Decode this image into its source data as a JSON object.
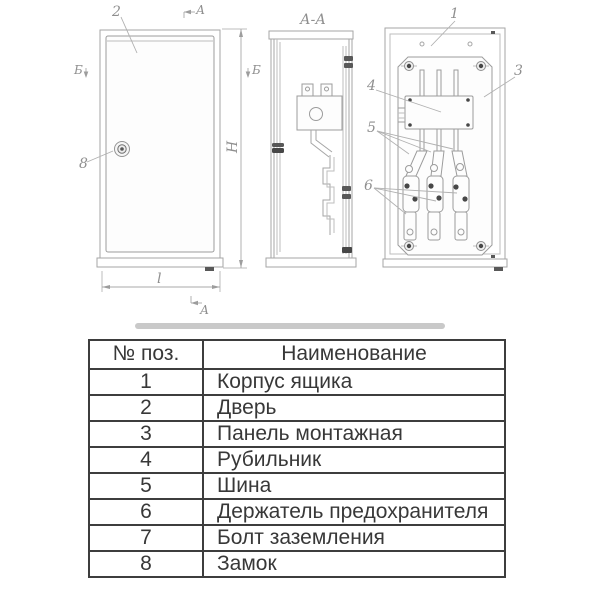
{
  "drawing": {
    "section_title": "А-А",
    "callouts": {
      "c1": "1",
      "c2": "2",
      "c3": "3",
      "c4": "4",
      "c5": "5",
      "c6": "6",
      "c8": "8"
    },
    "view_marks": {
      "section_top": "А",
      "section_bottom": "А",
      "b_left": "Б",
      "b_right": "Б"
    },
    "dimensions": {
      "height": "Н",
      "width": "l"
    },
    "colors": {
      "line": "#a6a6a6",
      "dark_detail": "#585858",
      "label_text": "#8f8f8f"
    }
  },
  "table": {
    "headers": {
      "pos": "№ поз.",
      "name": "Наименование"
    },
    "rows": [
      {
        "num": "1",
        "name": "Корпус ящика"
      },
      {
        "num": "2",
        "name": "Дверь"
      },
      {
        "num": "3",
        "name": "Панель монтажная"
      },
      {
        "num": "4",
        "name": "Рубильник"
      },
      {
        "num": "5",
        "name": "Шина"
      },
      {
        "num": "6",
        "name": "Держатель предохранителя"
      },
      {
        "num": "7",
        "name": "Болт заземления"
      },
      {
        "num": "8",
        "name": "Замок"
      }
    ],
    "colors": {
      "border": "#3d3d3d",
      "text": "#383838"
    }
  }
}
